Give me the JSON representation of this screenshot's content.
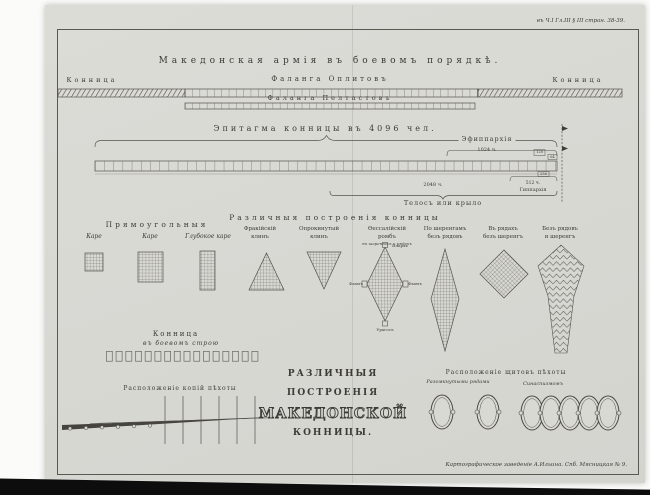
{
  "meta": {
    "corner_ref": "въ Ч.I Гл.III § III стран. 38-39.",
    "imprint": "Картографическое заведеніе А.Ильина. Спб. Мясницкая № 9."
  },
  "army_band": {
    "title": "Македонская армія въ боевомъ порядкѣ.",
    "cavalry_left": "Конница",
    "hoplites": "Фаланга Оплитовъ",
    "cavalry_right": "Конница",
    "peltasts": "Фаланга Пелтастовъ"
  },
  "epitagma": {
    "title": "Эпитагма конницы въ 4096 чел.",
    "ephipparchia": "Эфиппархія",
    "ephipparchia_count": "1024 ч.",
    "n128": "128",
    "n64": "64",
    "n256": "256",
    "hipparchia_count": "512 ч.",
    "hipparchia": "Гиппархія",
    "telos_count": "2048 ч.",
    "telos": "Телосъ или крыло"
  },
  "formations": {
    "header_rectangular": "Прямоугольныя",
    "header_various": "Различныя построенія конницы",
    "kare1": "Каре",
    "kare2": "Каре",
    "deep_kare": "Глубокое каре",
    "thracian1": "Фракійскій",
    "thracian2": "клинъ",
    "inverted1": "Опрокинутый",
    "inverted2": "клинъ",
    "thessalian1": "Ѳессалійскій",
    "thessalian2": "ромбъ",
    "thessalian_sub": "въ шеренгахъ и рядахъ",
    "rhomb_top": "Илархъ",
    "rhomb_bottom": "Урагосъ",
    "rhomb_left": "Флангъ",
    "rhomb_right": "Флангъ",
    "ranks1": "По шеренгамъ",
    "ranks2": "безъ рядовъ",
    "files1": "Въ рядахъ",
    "files2": "безъ шеренгъ",
    "none1": "Безъ рядовъ",
    "none2": "и шеренгъ"
  },
  "battle_line": {
    "title1": "Конница",
    "title2": "въ боевомъ строю"
  },
  "spears": {
    "title": "Расположеніе копій пѣхоты"
  },
  "main_title": {
    "line1": "РАЗЛИЧНЫЯ",
    "line2": "ПОСТРОЕНІЯ",
    "line3": "МАКЕДОНСКОЙ",
    "line4": "КОННИЦЫ."
  },
  "shields": {
    "title": "Расположеніе щитовъ пѣхоты",
    "open_label": "Разомкнутыми рядами",
    "closed_label": "Синаспизмомъ"
  },
  "colors": {
    "paper": "#d9d9d4",
    "ink": "#3c3b36"
  }
}
